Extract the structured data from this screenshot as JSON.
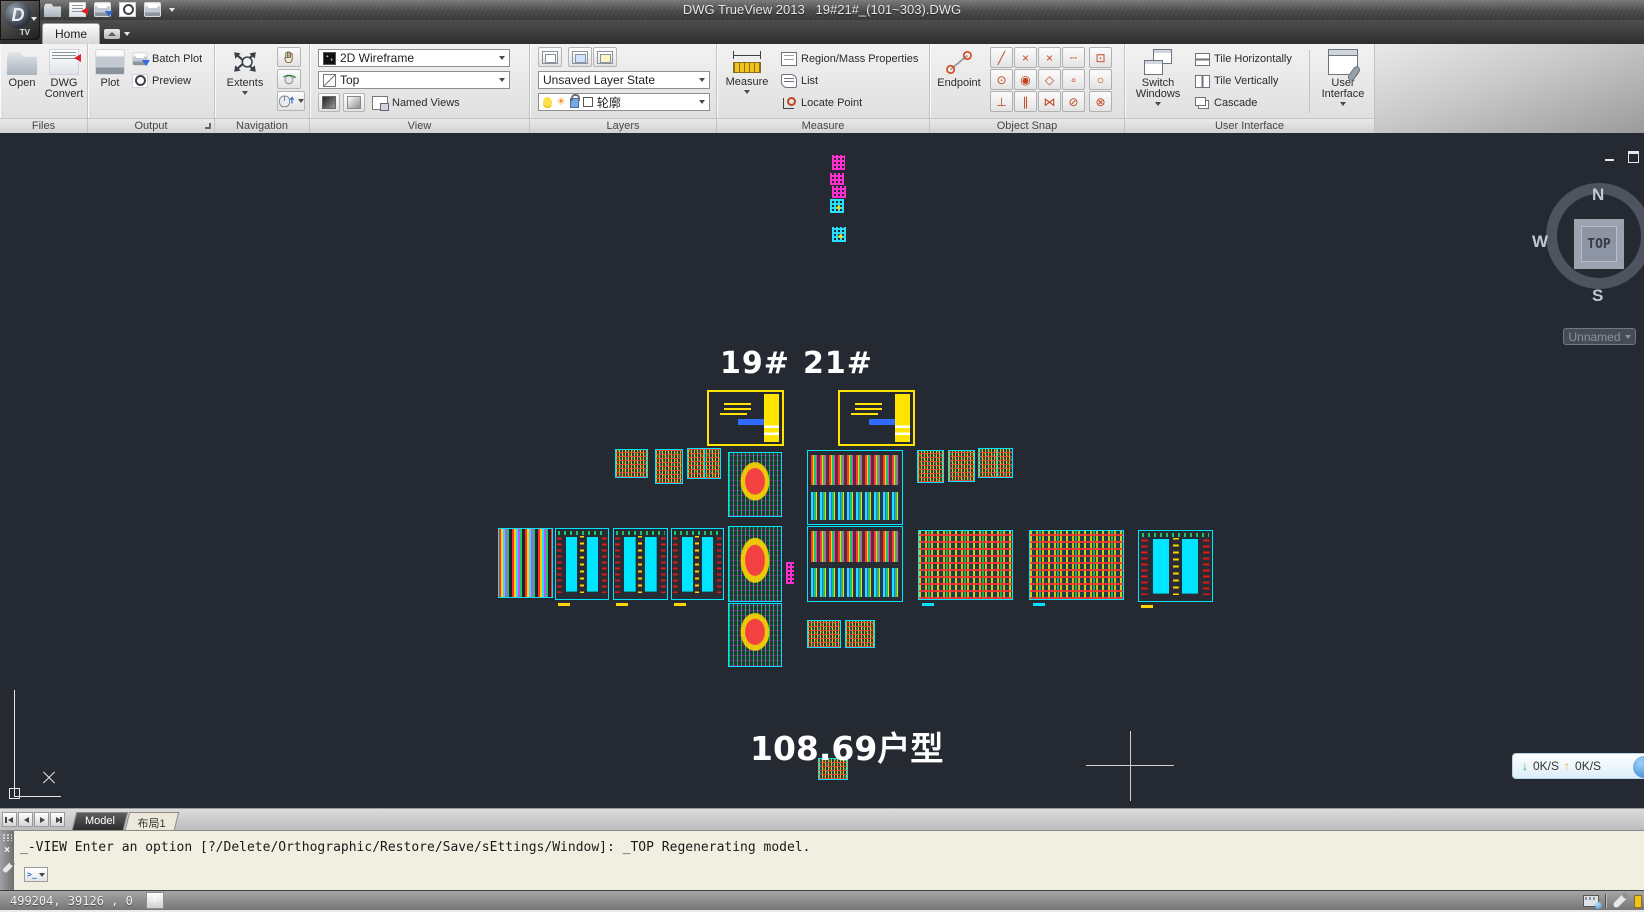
{
  "title_bar": {
    "title": "DWG TrueView 2013   19#21#_(101~303).DWG"
  },
  "app": {
    "badge": "TV",
    "logo_letter": "D"
  },
  "menu": {
    "home_tab": "Home"
  },
  "ribbon": {
    "panels": [
      {
        "caption": "Files"
      },
      {
        "caption": "Output"
      },
      {
        "caption": "Navigation"
      },
      {
        "caption": "View"
      },
      {
        "caption": "Layers"
      },
      {
        "caption": "Measure"
      },
      {
        "caption": "Object Snap"
      },
      {
        "caption": "User Interface"
      }
    ],
    "files": {
      "open": "Open",
      "dwg_convert": "DWG Convert"
    },
    "output": {
      "plot": "Plot",
      "batch_plot": "Batch Plot",
      "preview": "Preview"
    },
    "navigation": {
      "extents": "Extents"
    },
    "view": {
      "visual_style": "2D Wireframe",
      "current_view": "Top",
      "named_views": "Named Views"
    },
    "layers": {
      "layer_state": "Unsaved Layer State",
      "current_layer": "轮廓"
    },
    "measure": {
      "measure": "Measure",
      "region_mass": "Region/Mass Properties",
      "list": "List",
      "locate_point": "Locate Point"
    },
    "object_snap": {
      "endpoint": "Endpoint",
      "grid": [
        {
          "name": "snap-midpoint",
          "glyph": "╱"
        },
        {
          "name": "snap-intersection",
          "glyph": "×"
        },
        {
          "name": "snap-apparent-intersection",
          "glyph": "×"
        },
        {
          "name": "snap-extension",
          "glyph": "┄"
        },
        {
          "name": "snap-center",
          "glyph": "⊙"
        },
        {
          "name": "snap-geometric-center",
          "glyph": "◉"
        },
        {
          "name": "snap-quadrant",
          "glyph": "◇"
        },
        {
          "name": "snap-node",
          "glyph": "∘"
        },
        {
          "name": "snap-perpendicular",
          "glyph": "⊥"
        },
        {
          "name": "snap-parallel",
          "glyph": "∥"
        },
        {
          "name": "snap-nearest",
          "glyph": "⋈"
        },
        {
          "name": "snap-none",
          "glyph": "⊘"
        }
      ],
      "extra": [
        {
          "name": "snap-insert",
          "glyph": "⊡"
        },
        {
          "name": "snap-tangent",
          "glyph": "○"
        },
        {
          "name": "snap-magnet-off",
          "glyph": "⊗"
        }
      ]
    },
    "user_interface": {
      "switch_windows": "Switch Windows",
      "tile_h": "Tile Horizontally",
      "tile_v": "Tile Vertically",
      "cascade": "Cascade",
      "user_interface": "User Interface"
    }
  },
  "canvas": {
    "background_color": "#242932",
    "frame_color": "#00e5ff",
    "block_labels": {
      "b19": "19#",
      "b21": "21#"
    },
    "unit_label": "108.69户型",
    "viewcube": {
      "north": "N",
      "west": "W",
      "south": "S",
      "east": "E",
      "top": "TOP",
      "named_view": "Unnamed"
    },
    "drawings": [
      {
        "x": 832,
        "y": 22,
        "w": 13,
        "h": 15,
        "kind": "glyph-m"
      },
      {
        "x": 830,
        "y": 40,
        "w": 14,
        "h": 12,
        "kind": "glyph-m"
      },
      {
        "x": 832,
        "y": 53,
        "w": 14,
        "h": 12,
        "kind": "glyph-m"
      },
      {
        "x": 830,
        "y": 66,
        "w": 14,
        "h": 14,
        "kind": "glyph-c"
      },
      {
        "x": 832,
        "y": 94,
        "w": 14,
        "h": 15,
        "kind": "glyph-c"
      },
      {
        "x": 707,
        "y": 257,
        "w": 77,
        "h": 56,
        "kind": "titleblock"
      },
      {
        "x": 838,
        "y": 257,
        "w": 77,
        "h": 56,
        "kind": "titleblock"
      },
      {
        "x": 615,
        "y": 316,
        "w": 33,
        "h": 29,
        "kind": "small"
      },
      {
        "x": 655,
        "y": 316,
        "w": 28,
        "h": 35,
        "kind": "small"
      },
      {
        "x": 687,
        "y": 315,
        "w": 34,
        "h": 31,
        "kind": "small2"
      },
      {
        "x": 728,
        "y": 319,
        "w": 54,
        "h": 65,
        "kind": "plan"
      },
      {
        "x": 807,
        "y": 317,
        "w": 96,
        "h": 75,
        "kind": "cluster"
      },
      {
        "x": 917,
        "y": 317,
        "w": 27,
        "h": 33,
        "kind": "small"
      },
      {
        "x": 948,
        "y": 317,
        "w": 27,
        "h": 32,
        "kind": "small"
      },
      {
        "x": 978,
        "y": 315,
        "w": 35,
        "h": 30,
        "kind": "small2"
      },
      {
        "x": 498,
        "y": 395,
        "w": 55,
        "h": 70,
        "kind": "dense"
      },
      {
        "x": 555,
        "y": 395,
        "w": 54,
        "h": 72,
        "kind": "towers"
      },
      {
        "x": 613,
        "y": 395,
        "w": 55,
        "h": 72,
        "kind": "towers"
      },
      {
        "x": 671,
        "y": 395,
        "w": 53,
        "h": 72,
        "kind": "towers"
      },
      {
        "x": 728,
        "y": 393,
        "w": 54,
        "h": 76,
        "kind": "plan"
      },
      {
        "x": 807,
        "y": 393,
        "w": 96,
        "h": 76,
        "kind": "cluster"
      },
      {
        "x": 918,
        "y": 397,
        "w": 95,
        "h": 70,
        "kind": "densewide"
      },
      {
        "x": 1029,
        "y": 397,
        "w": 95,
        "h": 70,
        "kind": "densewide"
      },
      {
        "x": 1138,
        "y": 397,
        "w": 75,
        "h": 72,
        "kind": "towers"
      },
      {
        "x": 786,
        "y": 429,
        "w": 8,
        "h": 22,
        "kind": "glyph-m"
      },
      {
        "x": 728,
        "y": 470,
        "w": 54,
        "h": 64,
        "kind": "plan"
      },
      {
        "x": 807,
        "y": 487,
        "w": 34,
        "h": 28,
        "kind": "small"
      },
      {
        "x": 845,
        "y": 487,
        "w": 30,
        "h": 28,
        "kind": "small"
      },
      {
        "x": 818,
        "y": 625,
        "w": 30,
        "h": 22,
        "kind": "small"
      }
    ]
  },
  "net_overlay": {
    "down": "0K/S",
    "up": "0K/S"
  },
  "sheet_tabs": {
    "model": "Model",
    "layout1": "布局1"
  },
  "command_line": {
    "history": "_-VIEW Enter an option [?/Delete/Orthographic/Restore/Save/sEttings/Window]: _TOP Regenerating model."
  },
  "status_bar": {
    "coordinates": "499204, 39126 , 0"
  }
}
